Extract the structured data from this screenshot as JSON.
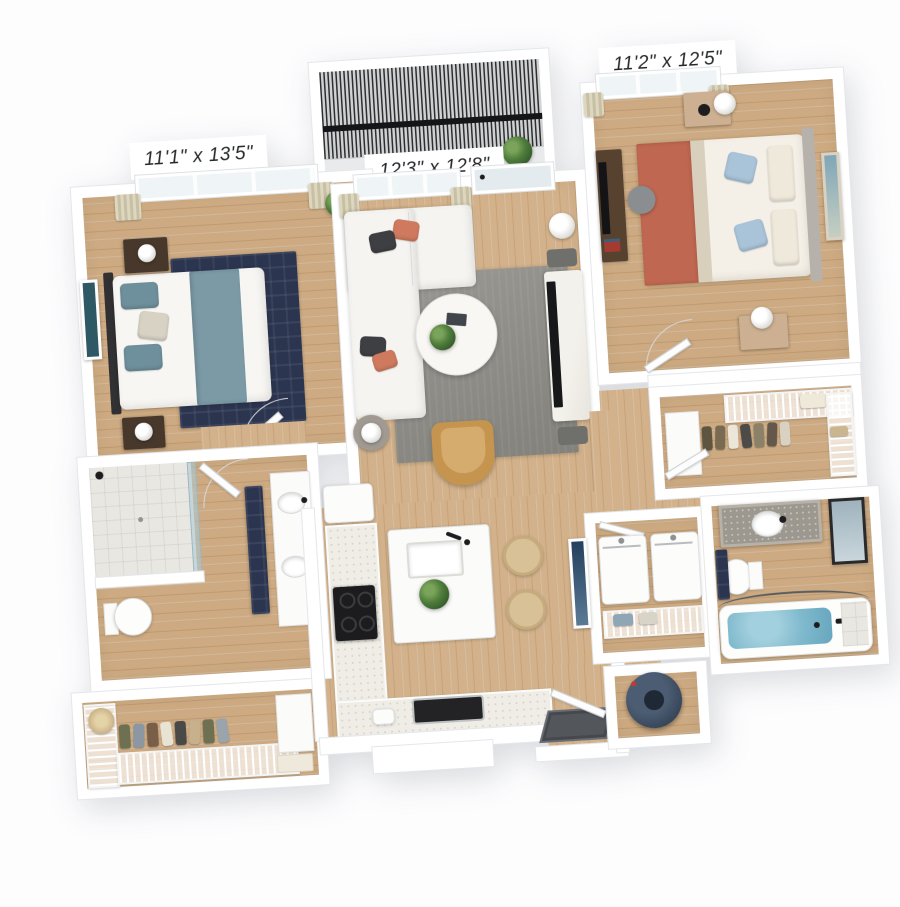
{
  "floorplan": {
    "rooms": {
      "bedroom_left": {
        "dimensions": "11'1\" x 13'5\""
      },
      "living_room": {
        "dimensions": "12'3\" x 12'8\""
      },
      "bedroom_right": {
        "dimensions": "11'2\" x 12'5\""
      }
    },
    "colors": {
      "wall_white": "#ffffff",
      "background": "#fdfdfe",
      "wood_floor": "#cdaa82",
      "wood_floor_light": "#d3b28b",
      "rug_navy": "#2c3550",
      "rug_gray": "#8e8c86",
      "sofa_white": "#f5f4f1",
      "pillow_coral": "#cf7a5e",
      "pillow_charcoal": "#3e3f42",
      "throw_teal": "#7b9aa6",
      "throw_terracotta": "#bf6750",
      "pillow_blue": "#a9c3d9",
      "accent_chair_camel": "#c5944e",
      "tub_water_blue": "#7fb9cd",
      "water_heater_navy": "#3a4859",
      "curtain_cream": "#d3cbae",
      "plant_green": "#4f7d3b",
      "railing_dark": "#2e2e30"
    }
  }
}
